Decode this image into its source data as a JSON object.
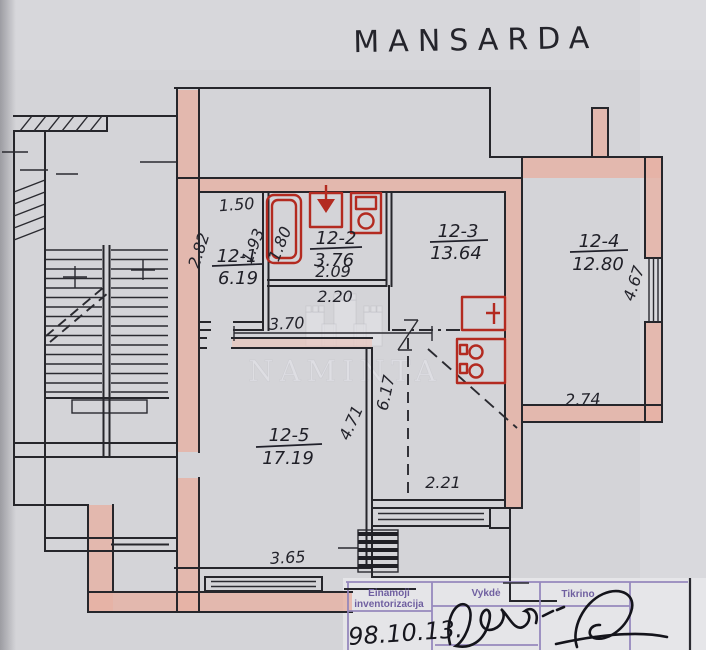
{
  "title": "MANSARDA",
  "watermark": {
    "text": "NAMINTA",
    "icon": "castle-logo"
  },
  "rooms": [
    {
      "id": "12-1",
      "area": "6.19"
    },
    {
      "id": "12-2",
      "area": "3.76"
    },
    {
      "id": "12-3",
      "area": "13.64"
    },
    {
      "id": "12-4",
      "area": "12.80"
    },
    {
      "id": "12-5",
      "area": "17.19"
    }
  ],
  "dims": {
    "w150": "1.50",
    "w282": "2.82",
    "w193": "1.93",
    "w180": "1.80",
    "w209": "2.09",
    "w220": "2.20",
    "w370": "3.70",
    "w617": "6.17",
    "w471": "4.71",
    "w221": "2.21",
    "w365": "3.65",
    "w467": "4.67",
    "w274": "2.74"
  },
  "stamp": {
    "col1_line1": "Einamoji",
    "col1_line2": "inventorizacija",
    "col2": "Vykdė",
    "col3": "Tikrino",
    "date": "98.10.13."
  },
  "colors": {
    "wall_pink": "#e7b2a5",
    "fixture_red": "#b32a20",
    "table_purple": "#9184bb",
    "ink": "#26262b",
    "paper": "#d4d4d8"
  }
}
